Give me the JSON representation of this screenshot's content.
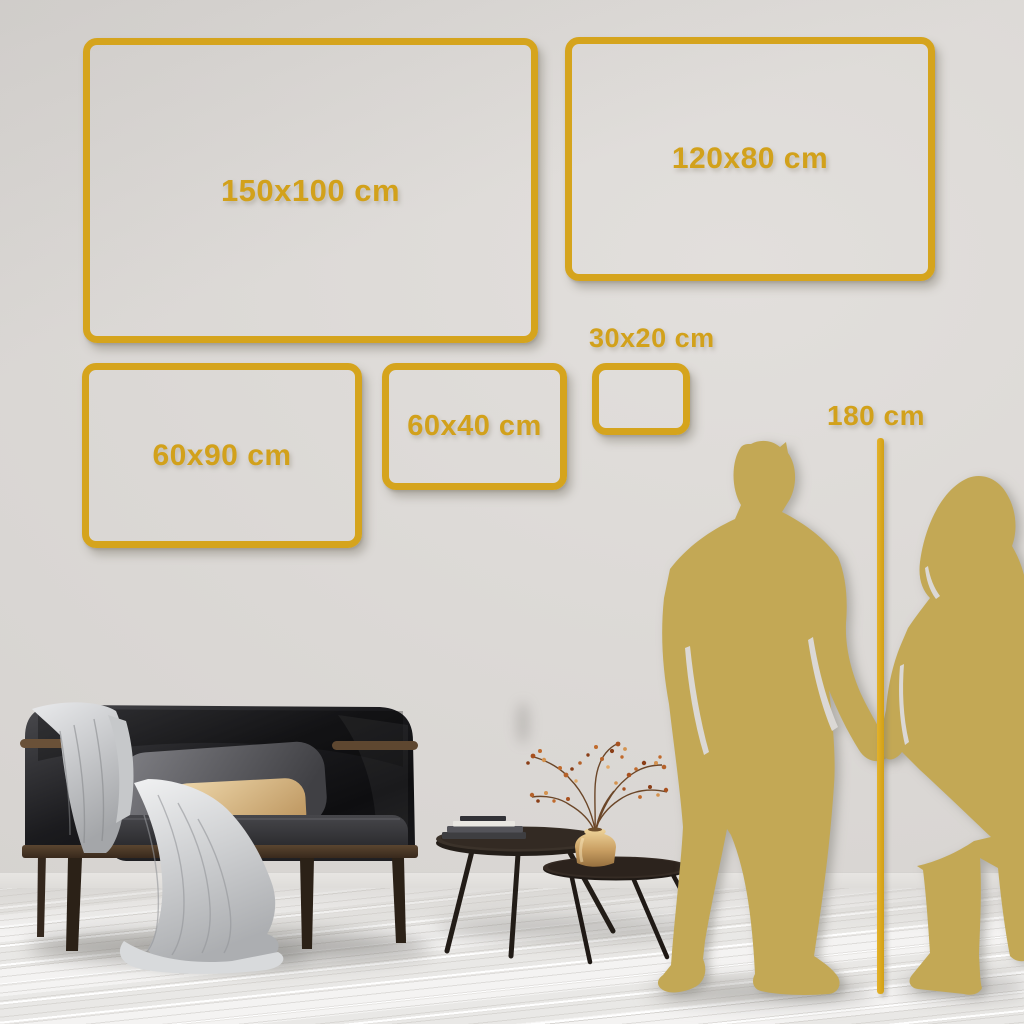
{
  "size_guide": {
    "frames": [
      {
        "id": "150x100",
        "label": "150x100 cm"
      },
      {
        "id": "120x80",
        "label": "120x80 cm"
      },
      {
        "id": "60x90",
        "label": "60x90 cm"
      },
      {
        "id": "60x40",
        "label": "60x40 cm"
      },
      {
        "id": "30x20",
        "label": "30x20 cm"
      }
    ],
    "height_reference": {
      "label": "180 cm"
    }
  },
  "colors": {
    "accent_gold": "#D5A41D",
    "silhouette_gold": "#C3A855",
    "wall": "#DBD8D5",
    "floor": "#F0EFED"
  },
  "scene": {
    "elements": [
      "man-silhouette",
      "woman-silhouette",
      "height-measure-line",
      "sofa",
      "throw-blanket",
      "back-pillow",
      "lumbar-pillow",
      "nesting-coffee-tables",
      "books-stack",
      "brass-vase",
      "dried-branch-plant"
    ]
  }
}
